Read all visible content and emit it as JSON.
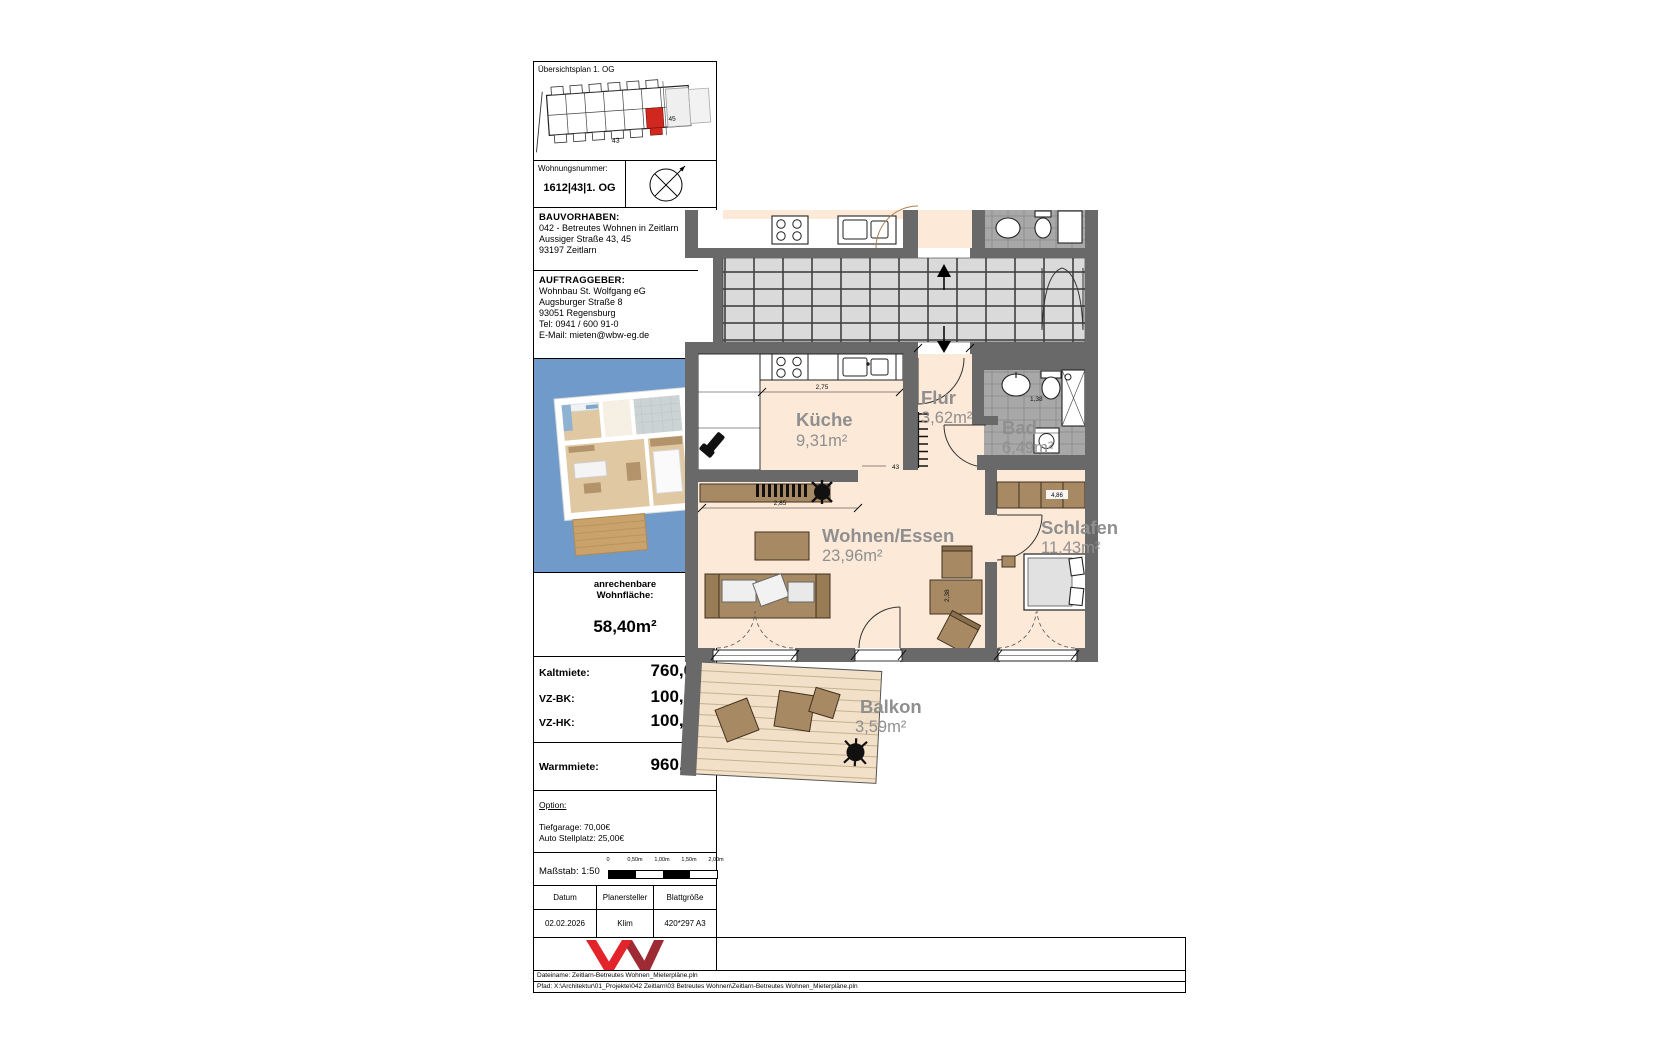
{
  "colors": {
    "photo_bg": "#6f9ac9",
    "unit_highlight": "#d0281f",
    "logo_red": "#e3242b",
    "logo_dark_red": "#9e2b33",
    "floor_peach": "#fce9d8",
    "label_gray": "#8f8f8f"
  },
  "sheet": {
    "overview": {
      "title": "Übersichtsplan  1. OG",
      "labels": {
        "left": "43",
        "right": "45"
      }
    },
    "unit": {
      "label": "Wohnungsnummer:",
      "value": "1612|43|1. OG"
    },
    "bauvorhaben": {
      "heading": "BAUVORHABEN:",
      "lines": [
        "042 - Betreutes Wohnen in Zeitlarn",
        "Aussiger Straße 43, 45",
        "93197 Zeitlarn"
      ]
    },
    "auftraggeber": {
      "heading": "AUFTRAGGEBER:",
      "lines": [
        "Wohnbau St. Wolfgang eG",
        "Augsburger Straße 8",
        "93051 Regensburg",
        "Tel: 0941 / 600 91-0",
        "E-Mail: mieten@wbw-eg.de"
      ]
    },
    "area": {
      "label1": "anrechenbare",
      "label2": "Wohnfläche:",
      "value": "58,40m²"
    },
    "rent": {
      "rows": [
        {
          "label": "Kaltmiete:",
          "value": "760,00€"
        },
        {
          "label": "VZ-BK:",
          "value": "100,00€"
        },
        {
          "label": "VZ-HK:",
          "value": "100,00€"
        }
      ],
      "warm_label": "Warmmiete:",
      "warm_value": "960,00€"
    },
    "option": {
      "heading": "Option:",
      "lines": [
        "Tiefgarage: 70,00€",
        "Auto Stellplatz: 25,00€"
      ]
    },
    "scale": {
      "label": "Maßstab: 1:50",
      "ticks": [
        "0",
        "0,50m",
        "1,00m",
        "1,50m",
        "2,00m"
      ]
    },
    "meta": {
      "headers": [
        "Datum",
        "Planersteller",
        "Blattgröße"
      ],
      "values": [
        "02.02.2026",
        "Klim",
        "420*297 A3"
      ]
    },
    "footer": {
      "line1": "Dateiname: Zeitlarn-Betreutes Wohnen_Mieterpläne.pln",
      "line2": "Pfad: X:\\Architektur\\01_Projekte\\042 Zeitlarn\\03 Betreutes Wohnen\\Zeitlarn-Betreutes Wohnen_Mieterpläne.pln"
    }
  },
  "plan": {
    "rooms": {
      "kueche": {
        "name": "Küche",
        "area": "9,31m²"
      },
      "flur": {
        "name": "Flur",
        "area": "3,62m²"
      },
      "bad": {
        "name": "Bad",
        "area": "6,49m²"
      },
      "wohnen": {
        "name": "Wohnen/Essen",
        "area": "23,96m²"
      },
      "schlafen": {
        "name": "Schlafen",
        "area": "11,43m²"
      },
      "balkon": {
        "name": "Balkon",
        "area": "3,59m²"
      }
    },
    "dimensions": {
      "kitchen": "2,75",
      "living": "2,85",
      "passage": "43",
      "wardrobe": "4,86",
      "living_h": "2,38",
      "bad": "1,38"
    }
  }
}
